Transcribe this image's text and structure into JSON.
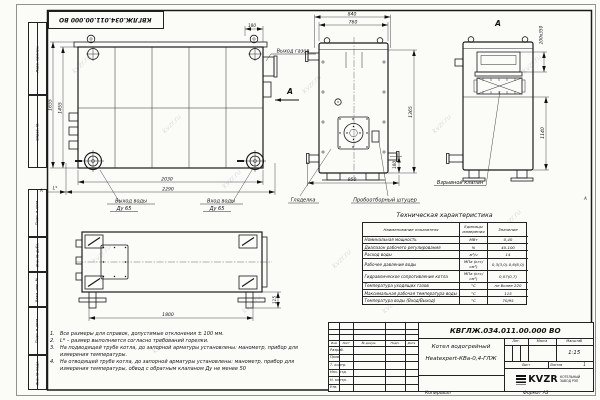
{
  "sheet": {
    "watermark": "kvzr.ru",
    "copied_label": "Копировал",
    "format_label": "Формат А3",
    "top_stamp": "КВГЛЖ.034.011.00.000 ВО",
    "zone": "А"
  },
  "margin": {
    "perv": "Перв. примен.",
    "sprav": "Справ. №",
    "podp1": "Подп. и дата",
    "inv_dubl": "Инв. № дубл.",
    "vzam": "Взам. инв. №",
    "podp2": "Подп. и дата",
    "inv_podl": "Инв. № подл."
  },
  "drawing": {
    "side": {
      "d1655": "1655",
      "d1455": "1455",
      "d180": "180",
      "d2030": "2030",
      "d2290": "2290",
      "lstar": "L*",
      "out": "Выход воды",
      "in": "Вход воды",
      "dn": "Ду 65"
    },
    "front": {
      "d840": "840",
      "d760": "760",
      "d1365": "1365",
      "d180": "180",
      "d950": "950",
      "gas": "Выход газов",
      "arrow": "А",
      "sight": "Гляделка",
      "sampling": "Пробоотборный штуцер"
    },
    "section": {
      "title": "А",
      "opening": "200х350",
      "d1140": "1140",
      "valve": "Взрывной клапан"
    },
    "top": {
      "d1800": "1800",
      "d115": "115"
    }
  },
  "notes": [
    {
      "n": "1.",
      "text": "Все размеры для справок, допустимые отклонения ± 100 мм."
    },
    {
      "n": "2.",
      "text": "L* – размер выполняется согласно требований горелки."
    },
    {
      "n": "3.",
      "text": "На подводящей трубе котла, до запорной арматуры установлены: манометр, прибор для измерения температуры."
    },
    {
      "n": "4.",
      "text": "На отводящей трубе котла, до запорной арматуры установлены: манометр, прибор для измерения температуры, обвод с обратным клапаном Ду не менее 50"
    }
  ],
  "tech": {
    "title": "Техническая характеристика",
    "h": [
      "Наименование показателя",
      "Единицы измерения",
      "Значение"
    ],
    "rows": [
      [
        "Номинальная мощность",
        "МВт",
        "0,40"
      ],
      [
        "Диапазон рабочего регулирования",
        "%",
        "40-100"
      ],
      [
        "Расход воды",
        "м³/ч",
        "14"
      ],
      [
        "Рабочее давление воды",
        "МПа (кгс/см²)",
        "0,3(3,0)-0,6(6,0)"
      ],
      [
        "Гидравлическое сопротивление котла",
        "МПа (кгс/см²)",
        "0,07(0,7)"
      ],
      [
        "Температура уходящих газов",
        "°С",
        "не более 220"
      ],
      [
        "Максимальная рабочая температура воды",
        "°С",
        "115"
      ],
      [
        "Температура воды (Вход/Выход)",
        "°С",
        "70/95"
      ]
    ]
  },
  "tb": {
    "doc": "КВГЛЖ.034.011.00.000 ВО",
    "name1": "Котел водогрейный",
    "name2": "Heatexpert-КВа-0,4-ГЛЖ",
    "lit": "Лит.",
    "mass": "Масса",
    "scale": "Масштаб",
    "scale_v": "1:15",
    "sheet": "Лист",
    "sheets": "Листов",
    "sheets_v": "1",
    "hdr": [
      "Изм",
      "Лист",
      "№ докум.",
      "Подп.",
      "Дата"
    ],
    "roles": [
      "Разраб.",
      "Пров.",
      "Т. контр.",
      "Нач. отд.",
      "Н. контр.",
      "Утв."
    ],
    "logo": "KVZR",
    "logo1": "КОТЕЛЬНЫЙ",
    "logo2": "ЗАВОД РЭП"
  }
}
